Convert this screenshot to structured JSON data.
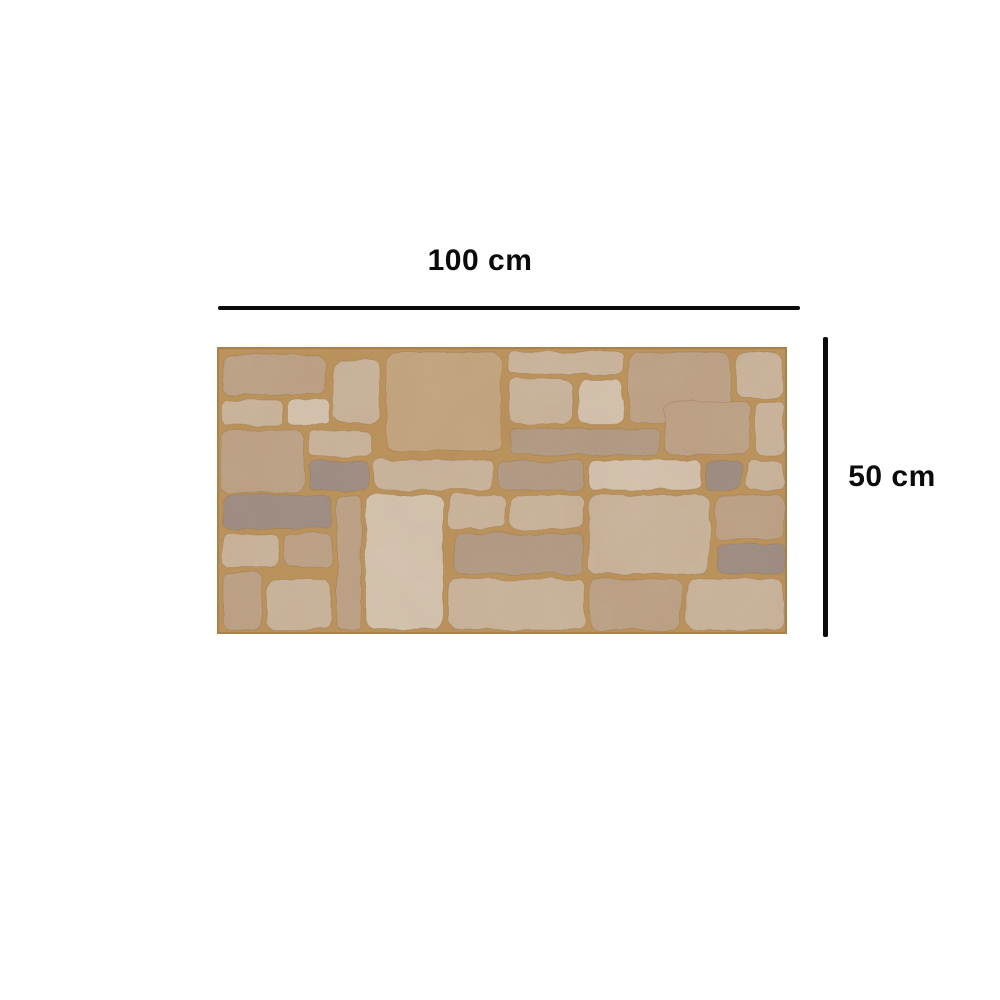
{
  "page": {
    "background_color": "#ffffff",
    "description": "Product dimension diagram of a decorative stone-look wall panel"
  },
  "dimensions": {
    "width_label": "100 cm",
    "height_label": "50 cm",
    "line_color": "#0b0b0b",
    "label_color": "#0b0b0b"
  },
  "panel": {
    "kind": "stone-wall-panel-image",
    "viewbox_width": 570,
    "viewbox_height": 287,
    "grout_color": "#c0975f",
    "edge_color": "#a8824c",
    "joint_stroke": "#9a7747",
    "palette": {
      "lightest": "#d9c8b4",
      "light": "#cfb9a1",
      "mid": "#c2a78c",
      "tan": "#c8ab85",
      "dark": "#a8917f",
      "gray": "#a39289",
      "mottled": "#b7a08a"
    },
    "stones": [
      {
        "x": 6,
        "y": 8,
        "w": 103,
        "h": 40,
        "c": "mid"
      },
      {
        "x": 116,
        "y": 14,
        "w": 46,
        "h": 62,
        "c": "light"
      },
      {
        "x": 169,
        "y": 6,
        "w": 115,
        "h": 98,
        "c": "tan"
      },
      {
        "x": 291,
        "y": 5,
        "w": 115,
        "h": 22,
        "c": "light"
      },
      {
        "x": 293,
        "y": 32,
        "w": 62,
        "h": 45,
        "c": "light"
      },
      {
        "x": 361,
        "y": 32,
        "w": 45,
        "h": 45,
        "c": "lightest"
      },
      {
        "x": 412,
        "y": 6,
        "w": 102,
        "h": 70,
        "c": "mid"
      },
      {
        "x": 520,
        "y": 6,
        "w": 46,
        "h": 45,
        "c": "light"
      },
      {
        "x": 6,
        "y": 53,
        "w": 60,
        "h": 25,
        "c": "light"
      },
      {
        "x": 71,
        "y": 53,
        "w": 41,
        "h": 25,
        "c": "lightest"
      },
      {
        "x": 4,
        "y": 83,
        "w": 83,
        "h": 63,
        "c": "mid"
      },
      {
        "x": 92,
        "y": 84,
        "w": 63,
        "h": 25,
        "c": "light"
      },
      {
        "x": 293,
        "y": 82,
        "w": 149,
        "h": 26,
        "c": "mottled"
      },
      {
        "x": 447,
        "y": 55,
        "w": 87,
        "h": 53,
        "c": "mid"
      },
      {
        "x": 539,
        "y": 55,
        "w": 28,
        "h": 53,
        "c": "light"
      },
      {
        "x": 92,
        "y": 114,
        "w": 60,
        "h": 29,
        "c": "gray"
      },
      {
        "x": 157,
        "y": 113,
        "w": 120,
        "h": 30,
        "c": "light"
      },
      {
        "x": 282,
        "y": 114,
        "w": 85,
        "h": 29,
        "c": "mottled"
      },
      {
        "x": 372,
        "y": 113,
        "w": 112,
        "h": 30,
        "c": "lightest"
      },
      {
        "x": 489,
        "y": 114,
        "w": 36,
        "h": 29,
        "c": "gray"
      },
      {
        "x": 530,
        "y": 114,
        "w": 37,
        "h": 29,
        "c": "light"
      },
      {
        "x": 6,
        "y": 148,
        "w": 109,
        "h": 34,
        "c": "gray"
      },
      {
        "x": 6,
        "y": 187,
        "w": 57,
        "h": 33,
        "c": "light"
      },
      {
        "x": 68,
        "y": 187,
        "w": 47,
        "h": 33,
        "c": "mid"
      },
      {
        "x": 120,
        "y": 148,
        "w": 24,
        "h": 135,
        "c": "mid"
      },
      {
        "x": 149,
        "y": 148,
        "w": 77,
        "h": 134,
        "c": "lightest"
      },
      {
        "x": 231,
        "y": 148,
        "w": 57,
        "h": 34,
        "c": "light"
      },
      {
        "x": 293,
        "y": 148,
        "w": 74,
        "h": 34,
        "c": "light"
      },
      {
        "x": 237,
        "y": 187,
        "w": 130,
        "h": 40,
        "c": "mottled"
      },
      {
        "x": 372,
        "y": 148,
        "w": 120,
        "h": 79,
        "c": "light"
      },
      {
        "x": 497,
        "y": 148,
        "w": 70,
        "h": 44,
        "c": "mid"
      },
      {
        "x": 500,
        "y": 197,
        "w": 67,
        "h": 30,
        "c": "gray"
      },
      {
        "x": 6,
        "y": 225,
        "w": 39,
        "h": 58,
        "c": "mid"
      },
      {
        "x": 50,
        "y": 232,
        "w": 64,
        "h": 51,
        "c": "light"
      },
      {
        "x": 231,
        "y": 232,
        "w": 136,
        "h": 51,
        "c": "light"
      },
      {
        "x": 372,
        "y": 232,
        "w": 92,
        "h": 51,
        "c": "mid"
      },
      {
        "x": 469,
        "y": 232,
        "w": 98,
        "h": 51,
        "c": "light"
      }
    ]
  }
}
